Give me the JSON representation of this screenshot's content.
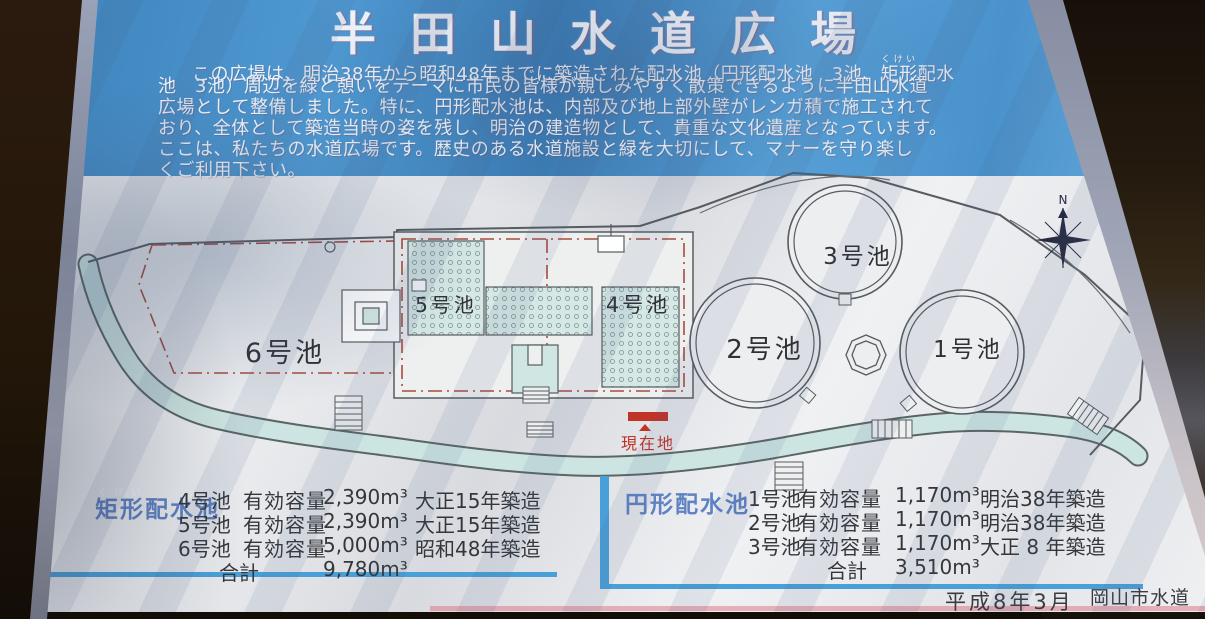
{
  "colors": {
    "header_blue": "#4a94cf",
    "accent_bar_blue": "#49a0d8",
    "table_header_blue": "#5f82c2",
    "marker_red": "#c23327",
    "map_line": "#565c60",
    "promenade_fill": "#cde5e2"
  },
  "sign": {
    "title": "半田山水道広場",
    "intro": {
      "line1_pre": "この広場は、明治38年から昭和48年までに築造された配水池（円形配水池　3池、",
      "line1_ruby_base": "矩形",
      "line1_ruby_rt": "くけい",
      "line1_post": "配水",
      "line2": "池　3池）周辺を緑と憩いをテーマに市民の皆様が親しみやすく散策できるように半田山水道",
      "line3": "広場として整備しました。特に、円形配水池は、内部及び地上部外壁がレンガ積で施工されて",
      "line4": "おり、全体として築造当時の姿を残し、明治の建造物として、貴重な文化遺産となっています。",
      "line5": "ここは、私たちの水道広場です。歴史のある水道施設と緑を大切にして、マナーを守り楽し",
      "line6": "くご利用下さい。"
    },
    "map": {
      "p1": "1号池",
      "p2": "2号池",
      "p3": "3号池",
      "p4": "4号池",
      "p5": "5号池",
      "p6": "6号池",
      "current_location": "現在地",
      "compass_north": "N"
    },
    "table_rect": {
      "header_ruby_base": "矩形",
      "header_ruby_rt": "くけい",
      "header_rest": "配水池",
      "rows": [
        {
          "pond": "4号池",
          "label": "有効容量",
          "volume": "2,390m³",
          "built": "大正15年築造"
        },
        {
          "pond": "5号池",
          "label": "有効容量",
          "volume": "2,390m³",
          "built": "大正15年築造"
        },
        {
          "pond": "6号池",
          "label": "有効容量",
          "volume": "5,000m³",
          "built": "昭和48年築造"
        }
      ],
      "total_label": "合計",
      "total_volume": "9,780m³"
    },
    "table_circle": {
      "header": "円形配水池",
      "rows": [
        {
          "pond": "1号池",
          "label": "有効容量",
          "volume": "1,170m³",
          "built": "明治38年築造"
        },
        {
          "pond": "2号池",
          "label": "有効容量",
          "volume": "1,170m³",
          "built": "明治38年築造"
        },
        {
          "pond": "3号池",
          "label": "有効容量",
          "volume": "1,170m³",
          "built": "大正 8 年築造"
        }
      ],
      "total_label": "合計",
      "total_volume": "3,510m³"
    },
    "footer": {
      "date": "平成8年3月",
      "agency": "岡山市水道局"
    }
  }
}
